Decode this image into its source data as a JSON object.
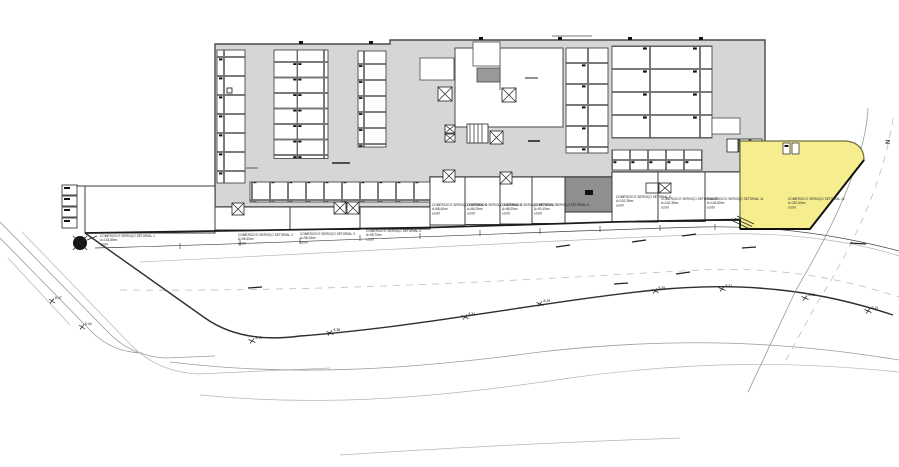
{
  "drawing": {
    "type": "architectural-site-plan",
    "highlight_color": "#f6ee8e",
    "plate_color": "#d6d6d6",
    "north": {
      "label": "N"
    },
    "units": [
      {
        "name": "COMÉRCIO E SERVIÇO SETORIAL 1",
        "area": "A=143,85m²",
        "level": "±0,00"
      },
      {
        "name": "COMÉRCIO E SERVIÇO SETORIAL 2",
        "area": "A=96,30m²",
        "level": "±0,00"
      },
      {
        "name": "COMÉRCIO E SERVIÇO SETORIAL 3",
        "area": "A=98,15m²",
        "level": "±0,00"
      },
      {
        "name": "COMÉRCIO E SERVIÇO SETORIAL 4",
        "area": "A=95,70m²",
        "level": "±0,00"
      },
      {
        "name": "COMÉRCIO E SERVIÇO SETORIAL 5",
        "area": "A=88,40m²",
        "level": "±0,00"
      },
      {
        "name": "COMÉRCIO E SERVIÇO SETORIAL 6",
        "area": "A=86,25m²",
        "level": "±0,00"
      },
      {
        "name": "COMÉRCIO E SERVIÇO SETORIAL 7",
        "area": "A=86,25m²",
        "level": "±0,00"
      },
      {
        "name": "COMÉRCIO E SERVIÇO SETORIAL 8",
        "area": "A=90,10m²",
        "level": "±0,00"
      },
      {
        "name": "COMÉRCIO E SERVIÇO SETORIAL 9",
        "area": "A=102,35m²",
        "level": "±0,00"
      },
      {
        "name": "COMÉRCIO E SERVIÇO SETORIAL 10",
        "area": "A=102,35m²",
        "level": "±0,00"
      },
      {
        "name": "COMÉRCIO E SERVIÇO SETORIAL 11",
        "area": "A=104,80m²",
        "level": "±0,00"
      },
      {
        "name": "COMÉRCIO E SERVIÇO SETORIAL 12",
        "area": "A=287,60m²",
        "level": "±0,00"
      }
    ],
    "elevation_markers": [
      {
        "value": "8.47"
      },
      {
        "value": "8.44"
      },
      {
        "value": "8.41"
      },
      {
        "value": "8.38"
      },
      {
        "value": "8.34"
      },
      {
        "value": "8.29"
      },
      {
        "value": "8.25"
      },
      {
        "value": "8.21"
      },
      {
        "value": "8.16"
      },
      {
        "value": "8.12"
      }
    ]
  }
}
